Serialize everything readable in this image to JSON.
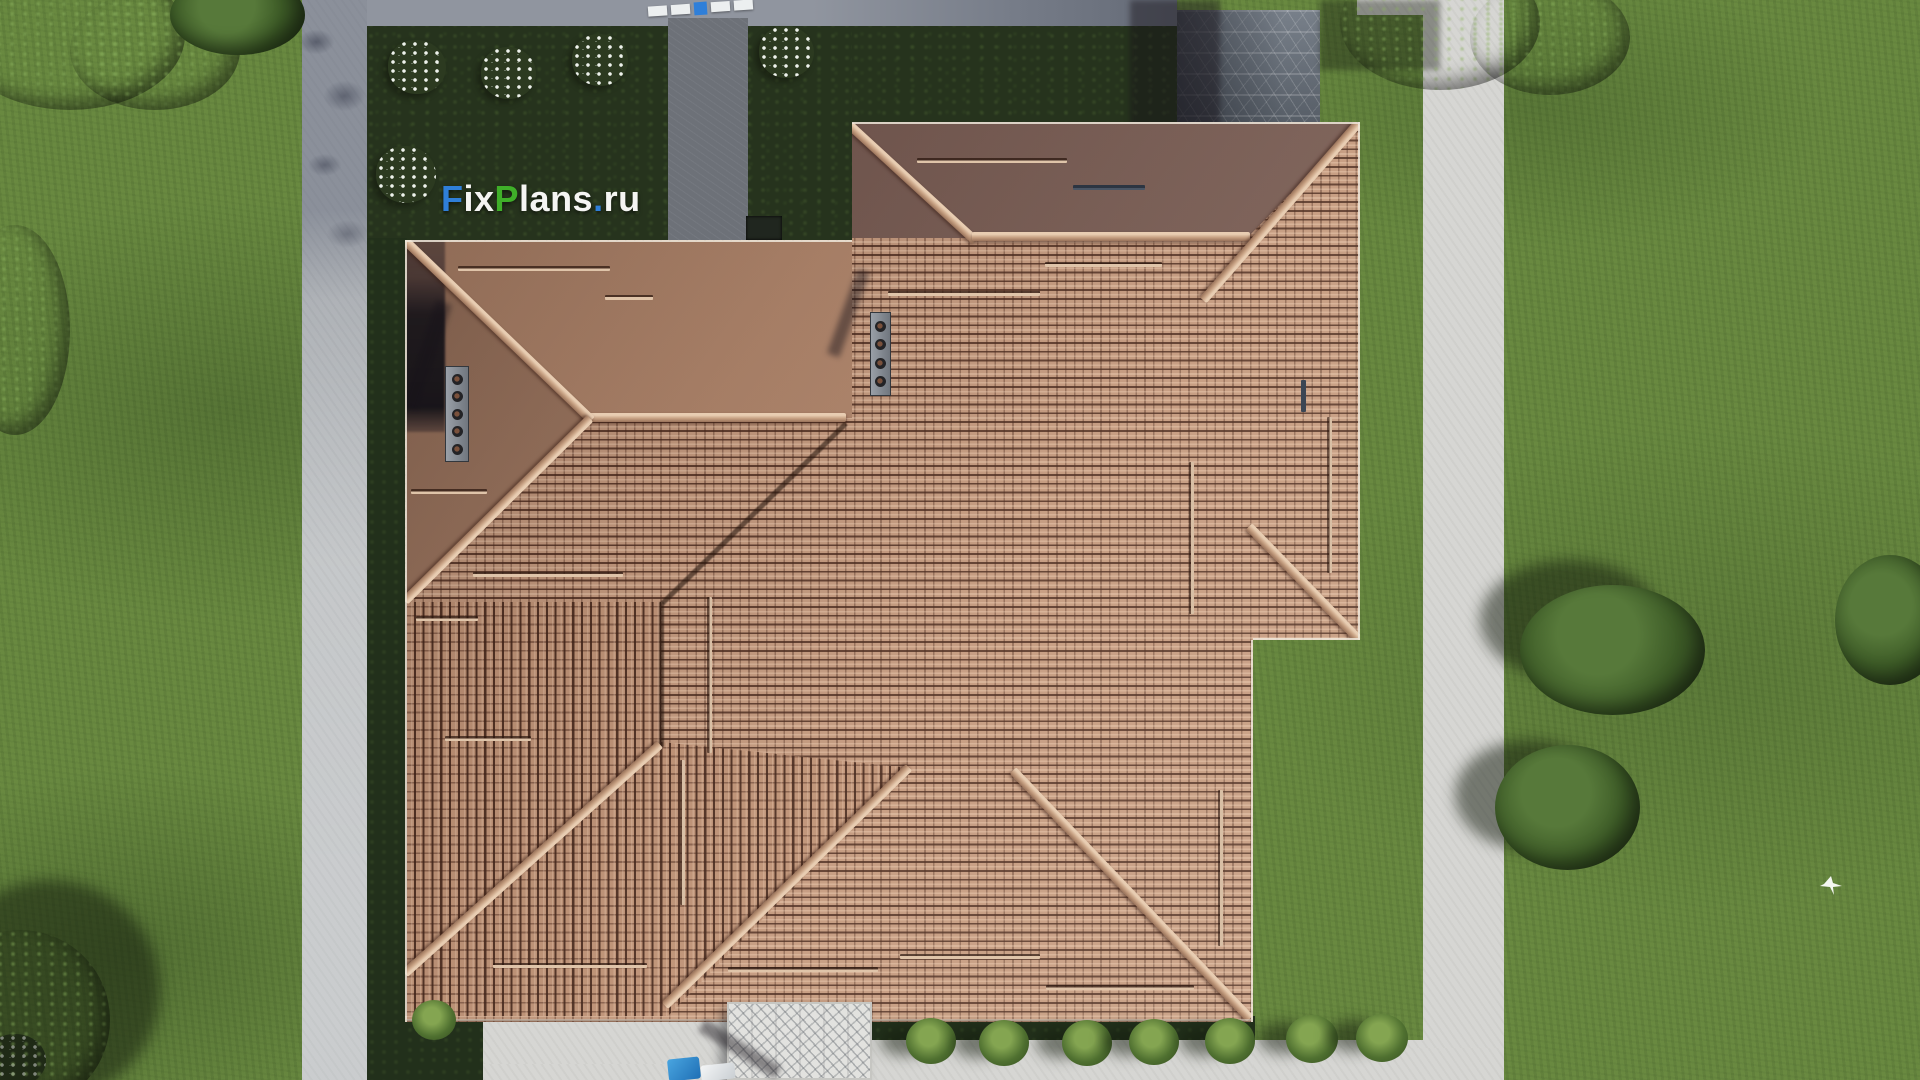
{
  "watermark": {
    "full_text": "FixPlans.ru",
    "segments": [
      {
        "text": "F",
        "color": "#2f7fd9"
      },
      {
        "text": "ix",
        "color": "#f5f5f3"
      },
      {
        "text": "P",
        "color": "#3faf29"
      },
      {
        "text": "lans",
        "color": "#f5f5f3"
      },
      {
        "text": ".",
        "color": "#2f7fd9"
      },
      {
        "text": "ru",
        "color": "#f5f5f3"
      }
    ]
  },
  "scene": {
    "description_label": "top-down 3d render of a house with hipped terracotta tile roof, lawn and concrete paths",
    "palette": {
      "grass": "#67873f",
      "grass_shadow": "#2c4419",
      "garden_bed": "#26331d",
      "hedge": "#22301b",
      "tree_foliage": "#2a4119",
      "path_light": "#d6d6d3",
      "path_shaded": "#7c828e",
      "walkway": "#6d7178",
      "roof_tile": "#c09478",
      "roof_tile_shadowed": "#6f5750",
      "roof_ridge": "#dfc4a9",
      "stone_steps": "#5d646d",
      "pergola_canopy": "#e2e2df",
      "car_blue": "#2f8fd0",
      "car_white": "#eef0f1",
      "flower_white": "#eef2ec"
    },
    "objects": {
      "flower_bushes": 6,
      "green_shrubs": 8,
      "roof_vent_stacks": 2,
      "snow_guard_bars": 20,
      "stone_step_slabs": 6,
      "cars": 2,
      "birds": 1
    }
  }
}
